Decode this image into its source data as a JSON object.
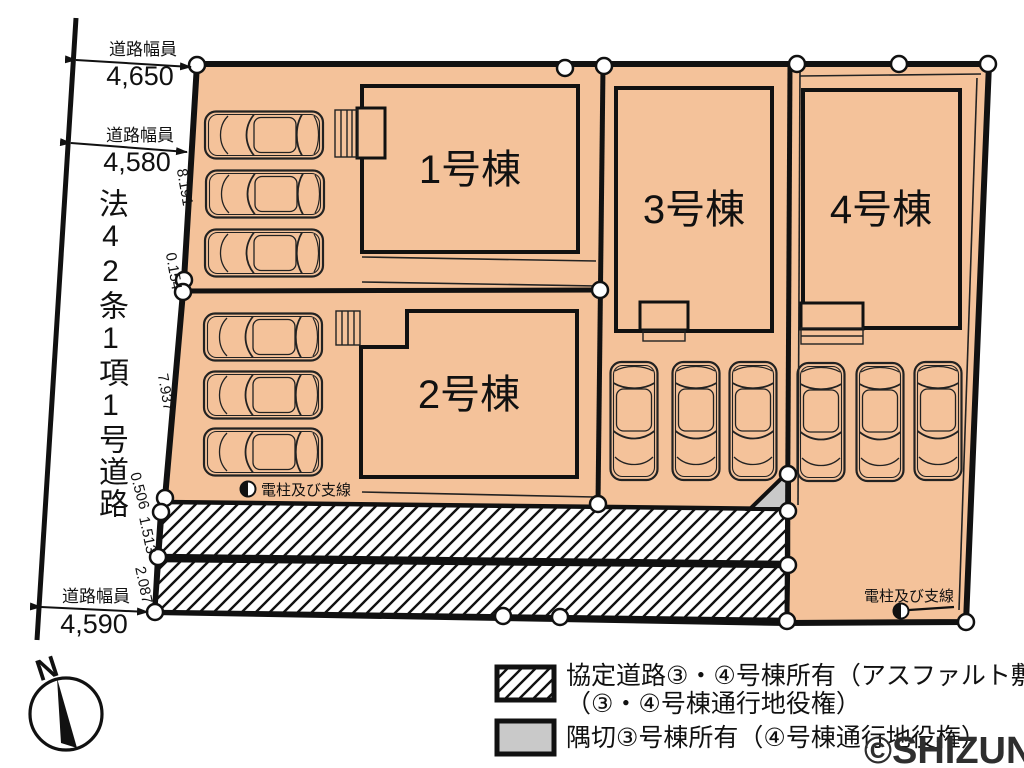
{
  "colors": {
    "site_fill": "#f4c29a",
    "corner_fill": "#c9c9c9",
    "line": "#111111",
    "background": "#ffffff"
  },
  "road": {
    "name": "法42条1項1号道路",
    "width_top": {
      "label": "道路幅員",
      "value": "4,650"
    },
    "width_mid": {
      "label": "道路幅員",
      "value": "4,580"
    },
    "width_bottom": {
      "label": "道路幅員",
      "value": "4,590"
    }
  },
  "boundary_dimensions": {
    "d1": "8.191",
    "d2": "0.154",
    "d3": "7.937",
    "d4": "0.506",
    "d5": "1.513",
    "d6": "2.087"
  },
  "buildings": {
    "b1": "1号棟",
    "b2": "2号棟",
    "b3": "3号棟",
    "b4": "4号棟"
  },
  "utility": {
    "pole1": "電柱及び支線",
    "pole2": "電柱及び支線"
  },
  "legend": {
    "agreement_road_line1": "協定道路③・④号棟所有（アスファルト敷き）",
    "agreement_road_line2": "（③・④号棟通行地役権）",
    "corner_cut": "隅切③号棟所有（④号棟通行地役権）"
  },
  "compass": {
    "north": "N"
  },
  "watermark": "©SHIZUNAVI"
}
